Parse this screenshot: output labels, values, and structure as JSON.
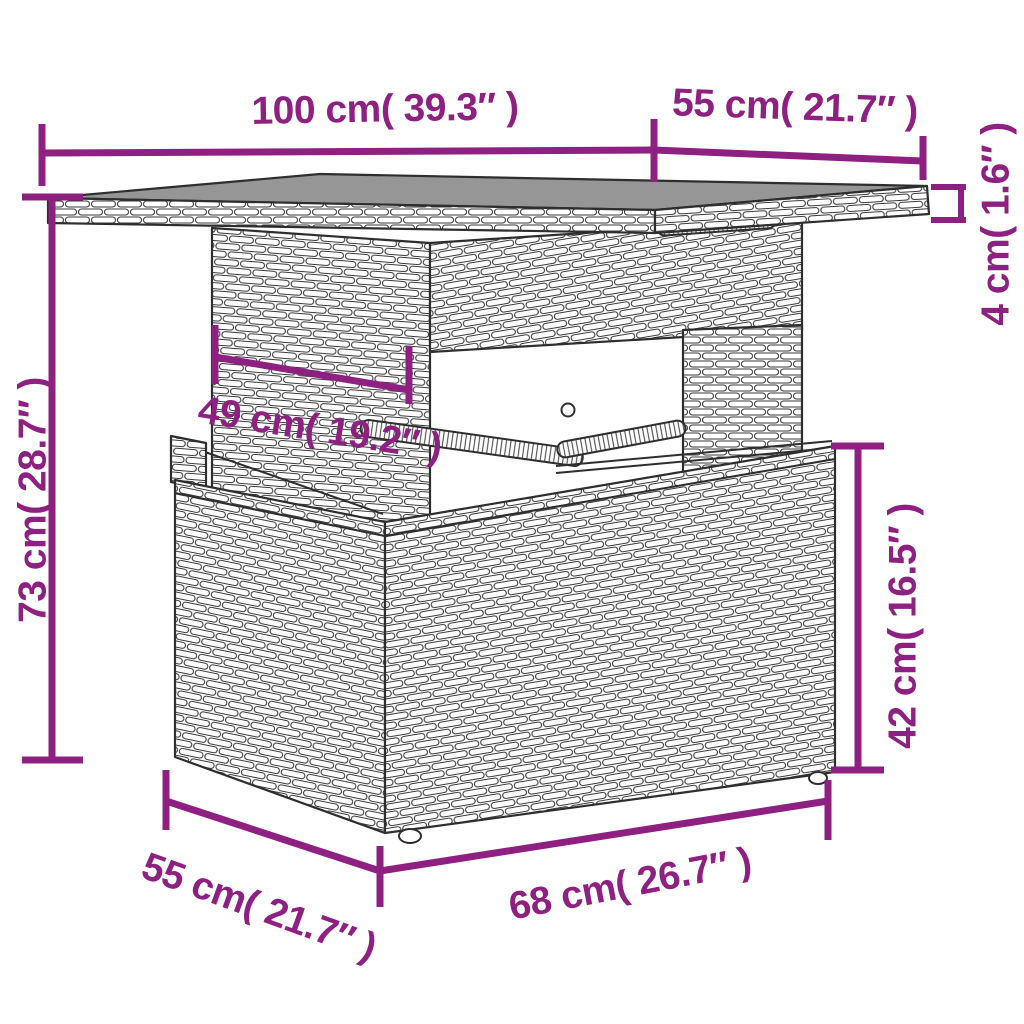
{
  "colors": {
    "accent": "#8e2082",
    "line_art": "#3a3a3a",
    "tabletop_surface": "#969696"
  },
  "diagram": {
    "subject": "poly rattan garden table with glass-look top, pedestal and storage base"
  },
  "dimensions": {
    "tabletop_width": {
      "label": "100 cm( 39.3″ )",
      "cm": 100,
      "inches": 39.3
    },
    "tabletop_depth": {
      "label": "55 cm( 21.7″ )",
      "cm": 55,
      "inches": 21.7
    },
    "tabletop_thickness": {
      "label": "4 cm( 1.6″ )",
      "cm": 4,
      "inches": 1.6
    },
    "total_height": {
      "label": "73 cm( 28.7″ )",
      "cm": 73,
      "inches": 28.7
    },
    "pedestal_width": {
      "label": "49 cm( 19.2″ )",
      "cm": 49,
      "inches": 19.2
    },
    "base_height": {
      "label": "42 cm( 16.5″ )",
      "cm": 42,
      "inches": 16.5
    },
    "base_depth": {
      "label": "55 cm( 21.7″ )",
      "cm": 55,
      "inches": 21.7
    },
    "base_width": {
      "label": "68 cm( 26.7″ )",
      "cm": 68,
      "inches": 26.7
    }
  }
}
